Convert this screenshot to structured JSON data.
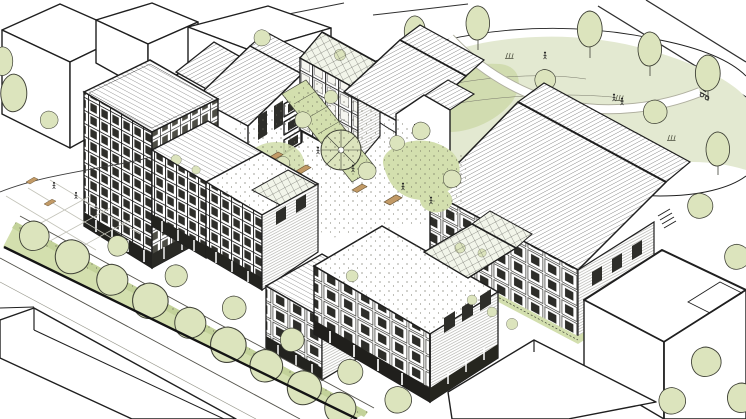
{
  "scene": {
    "title": "Axonometric architectural sketch of a residential courtyard-block development",
    "description": "Hand-drawn aerial axonometric ink illustration of a housing scheme: perimeter apartment blocks with hatched gabled and flat roofs, gridded facades with balconies, a planted central courtyard with a round garden feature and sloping green ramp, a wildflower meadow with trees and footpaths to the north-east, a tree-lined hedge along the south-west street, and plain white neighbouring context volumes at the corners.",
    "view": "aerial axonometric",
    "medium": "black ink line drawing with light green landscape tint",
    "background": "#ffffff"
  },
  "palette": {
    "ink": "#1f1f1f",
    "paper": "#ffffff",
    "tree": "#dce4bd",
    "hedge": "#d3dfae",
    "hedgeShade": "#c3d29a",
    "meadow": "#e3e9d1",
    "meadowShade": "#ccd8a7",
    "glass": "#f2f5ea",
    "windowDark": "#2e2e2a",
    "furniture": "#c29a66",
    "paving": "#c2c2b8"
  },
  "inventory": {
    "context_buildings": 6,
    "development_blocks": 10,
    "gabled_hatched_roofs": 6,
    "flat_hatched_roofs": 3,
    "glass_roofs": 3,
    "trees": 39,
    "hedgerow_trees": 9,
    "shrubs": 3,
    "roof_planting_patches": 4,
    "benches_and_planters": 4,
    "pedestrians": 10,
    "cyclists": 1,
    "round_garden_features": 1,
    "meadow_footpaths": 2
  },
  "labels": {
    "context": [
      "neighbouring-block-northwest",
      "neighbouring-slab-north-left",
      "neighbouring-slab-north-right",
      "neighbouring-slab-southwest",
      "neighbouring-box-southeast-upper",
      "neighbouring-box-southeast-lower"
    ],
    "blocks": [
      {
        "id": "left-tower-block",
        "label": "Six-storey corner block, flat hatched roof, dark window grid"
      },
      {
        "id": "stepped-terrace",
        "label": "Stepped mid-rise terrace descending along the street"
      },
      {
        "id": "west-gabled-house-small",
        "label": "Small gabled house behind tower"
      },
      {
        "id": "west-gabled-house",
        "label": "Gabled house with balcony stack on gable end"
      },
      {
        "id": "courtyard-hall",
        "label": "Four-storey hall with glazed shed roof"
      },
      {
        "id": "north-gabled-house",
        "label": "Gabled house with hatched roof"
      },
      {
        "id": "white-gable-house",
        "label": "Plain white gable end with small window"
      },
      {
        "id": "east-balcony-building",
        "label": "Long gabled building, facade of cubic balconies"
      },
      {
        "id": "south-corner-block",
        "label": "Corner block with rooftop conservatory and arcade"
      },
      {
        "id": "street-terrace-low",
        "label": "Lower balcony terrace on the street"
      }
    ],
    "landscape": [
      "central-courtyard-garden",
      "round-garden-feature",
      "planted-ramp",
      "wildflower-meadow",
      "meadow-footpath",
      "street-hedgerow",
      "street-trees",
      "scattered-trees"
    ]
  }
}
